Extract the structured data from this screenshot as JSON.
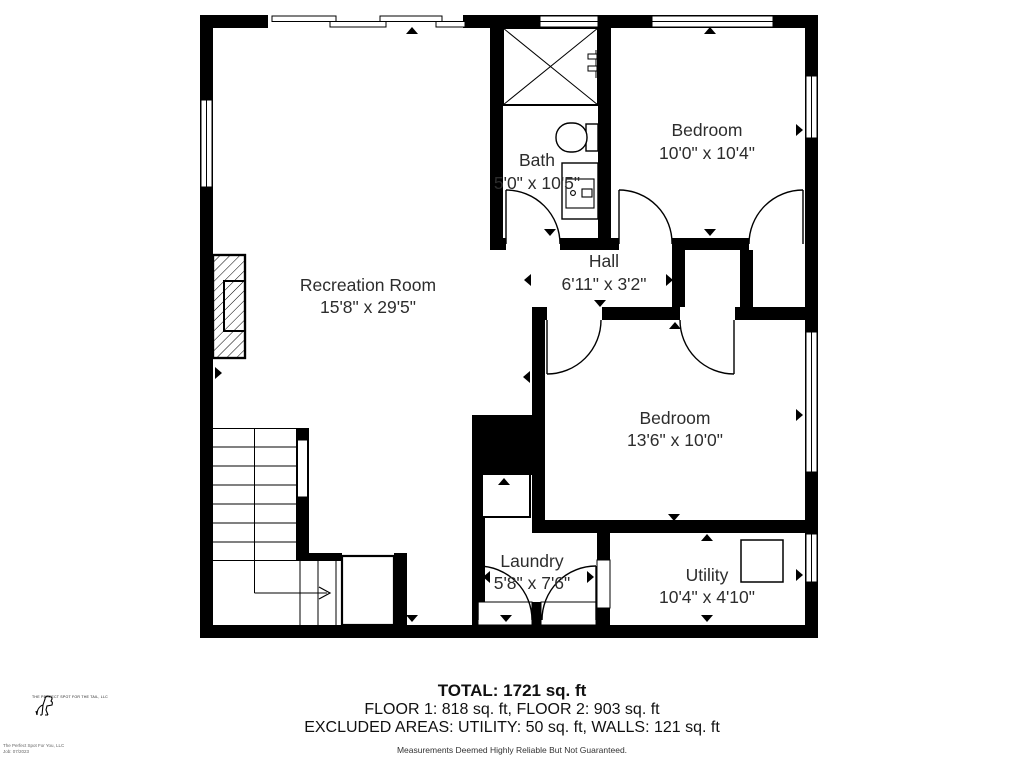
{
  "rooms": [
    {
      "name": "Recreation Room",
      "dims": "15'8\" x 29'5\""
    },
    {
      "name": "Bath",
      "dims": "5'0\" x 10'5\""
    },
    {
      "name": "Bedroom",
      "dims": "10'0\" x 10'4\""
    },
    {
      "name": "Hall",
      "dims": "6'11\" x 3'2\""
    },
    {
      "name": "Bedroom",
      "dims": "13'6\" x 10'0\""
    },
    {
      "name": "Laundry",
      "dims": "5'8\" x 7'6\""
    },
    {
      "name": "Utility",
      "dims": "10'4\" x 4'10\""
    }
  ],
  "summary": {
    "total": "TOTAL: 1721 sq. ft",
    "floors": "FLOOR 1: 818 sq. ft, FLOOR 2: 903 sq. ft",
    "excluded": "EXCLUDED AREAS: UTILITY: 50 sq. ft, WALLS: 121 sq. ft",
    "disclaimer": "Measurements Deemed Highly Reliable But Not Guaranteed."
  },
  "branding": {
    "logo_text": "THE PERFECT SPOT FOR THE TAIL, LLC",
    "footnote_line1": "The Perfect Spot For You, LLC",
    "footnote_line2": "Job: 07/2023"
  },
  "colors": {
    "walls": "#000000",
    "room_fill": "#ffffff",
    "label_text": "#2d2d2d"
  }
}
